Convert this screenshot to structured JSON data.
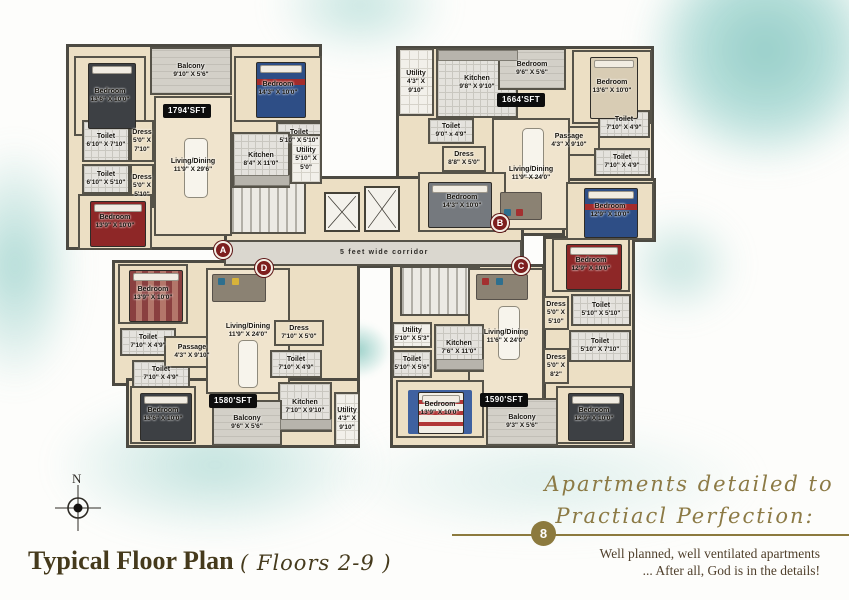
{
  "plan": {
    "corridor": "5 feet wide corridor",
    "colors": {
      "teal_wash": "#8ccac4",
      "wall": "#4c4a42",
      "floor_cream": "#ecdfc4",
      "marker_red": "#7d1e1e",
      "sft_badge_bg": "#0d0d0d",
      "accent_olive": "#8c7a3e"
    },
    "markers": [
      {
        "label": "A"
      },
      {
        "label": "B"
      },
      {
        "label": "C"
      },
      {
        "label": "D"
      }
    ],
    "apartments": [
      {
        "name": "Apartment A",
        "sft": "1794'SFT",
        "rooms": [
          {
            "name": "Bedroom",
            "dims": "13'6\" X 10'0\""
          },
          {
            "name": "Balcony",
            "dims": "9'10\" X 5'6\""
          },
          {
            "name": "Bedroom",
            "dims": "14'3\" X 10'0\""
          },
          {
            "name": "Toilet",
            "dims": "6'10\" X 7'10\""
          },
          {
            "name": "Dress",
            "dims": "5'0\" X 7'10\""
          },
          {
            "name": "Toilet",
            "dims": "6'10\" X 5'10\""
          },
          {
            "name": "Dress",
            "dims": "5'0\" X 5'10\""
          },
          {
            "name": "Toilet",
            "dims": "5'10\" X 5'10\""
          },
          {
            "name": "Kitchen",
            "dims": "8'4\" X 11'0\""
          },
          {
            "name": "Utility",
            "dims": "5'10\" X 5'0\""
          },
          {
            "name": "Living/Dining",
            "dims": "11'9\" X 29'6\""
          },
          {
            "name": "Bedroom",
            "dims": "13'9\" X 10'0\""
          }
        ]
      },
      {
        "name": "Apartment B",
        "sft": "1664'SFT",
        "rooms": [
          {
            "name": "Utility",
            "dims": "4'3\" X 9'10\""
          },
          {
            "name": "Kitchen",
            "dims": "9'8\" X 9'10\""
          },
          {
            "name": "Bedroom",
            "dims": "9'6\" X 5'6\""
          },
          {
            "name": "Bedroom",
            "dims": "13'6\" X 10'0\""
          },
          {
            "name": "Toilet",
            "dims": "9'0\" x 4'9\""
          },
          {
            "name": "Passage",
            "dims": "4'3\" X 9'10\""
          },
          {
            "name": "Toilet",
            "dims": "7'10\" X 4'9\""
          },
          {
            "name": "Toilet",
            "dims": "7'10\" X 4'9\""
          },
          {
            "name": "Dress",
            "dims": "8'8\" X 5'0\""
          },
          {
            "name": "Living/Dining",
            "dims": "11'9\" X 24'0\""
          },
          {
            "name": "Bedroom",
            "dims": "14'3\" X 10'0\""
          },
          {
            "name": "Bedroom",
            "dims": "12'9\" X 10'0\""
          }
        ]
      },
      {
        "name": "Apartment C",
        "sft": "1590'SFT",
        "rooms": [
          {
            "name": "Bedroom",
            "dims": "12'9\" X 10'0\""
          },
          {
            "name": "Dress",
            "dims": "5'0\" X 5'10\""
          },
          {
            "name": "Toilet",
            "dims": "5'10\" X 5'10\""
          },
          {
            "name": "Toilet",
            "dims": "5'10\" X 7'10\""
          },
          {
            "name": "Dress",
            "dims": "5'0\" X 8'2\""
          },
          {
            "name": "Living/Dining",
            "dims": "11'6\" X 24'0\""
          },
          {
            "name": "Utility",
            "dims": "5'10\" X 5'3\""
          },
          {
            "name": "Kitchen",
            "dims": "7'6\" X 11'0\""
          },
          {
            "name": "Toilet",
            "dims": "5'10\" X 5'6\""
          },
          {
            "name": "Bedroom",
            "dims": "13'9\" X 10'0\""
          },
          {
            "name": "Balcony",
            "dims": "9'3\" X 5'6\""
          },
          {
            "name": "Bedroom",
            "dims": "12'9\" X 10'0\""
          }
        ]
      },
      {
        "name": "Apartment D",
        "sft": "1580'SFT",
        "rooms": [
          {
            "name": "Bedroom",
            "dims": "13'9\" X 10'0\""
          },
          {
            "name": "Toilet",
            "dims": "7'10\" X 4'9\""
          },
          {
            "name": "Toilet",
            "dims": "7'10\" X 4'9\""
          },
          {
            "name": "Passage",
            "dims": "4'3\" X 9'10\""
          },
          {
            "name": "Living/Dining",
            "dims": "11'9\" X 24'0\""
          },
          {
            "name": "Dress",
            "dims": "7'10\" X 5'0\""
          },
          {
            "name": "Toilet",
            "dims": "7'10\" X 4'9\""
          },
          {
            "name": "Kitchen",
            "dims": "7'10\" X 9'10\""
          },
          {
            "name": "Utility",
            "dims": "4'3\" X 9'10\""
          },
          {
            "name": "Bedroom",
            "dims": "13'6\" X 10'0\""
          },
          {
            "name": "Balcony",
            "dims": "9'6\" X 5'6\""
          }
        ]
      }
    ]
  },
  "footer": {
    "compass_label": "N",
    "title": "Typical Floor Plan",
    "title_script": "( Floors 2-9 )",
    "badge": "8",
    "script_line1": "Apartments detailed to",
    "script_line2": "Practiacl Perfection:",
    "sub_line1": "Well planned, well ventilated apartments",
    "sub_line2": "... After all, God is in the details!"
  }
}
